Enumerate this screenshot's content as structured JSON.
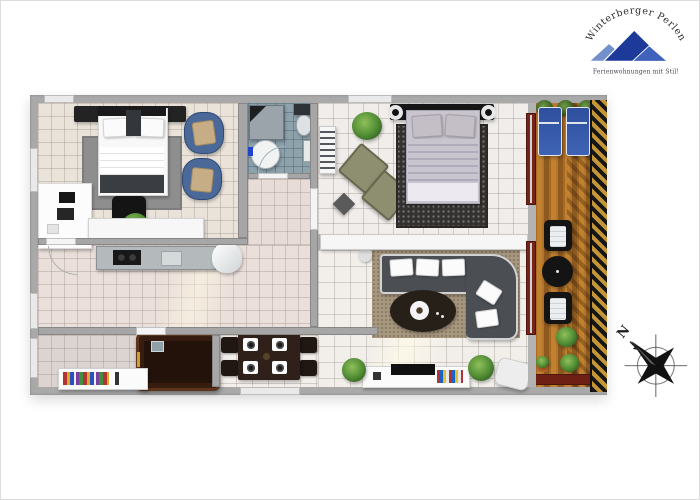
{
  "branding": {
    "title": "Winterberger Perlen",
    "tagline": "Ferienwohnungen mit Stil!"
  },
  "compass": {
    "label": "N"
  },
  "icons": {
    "logo_mountain_icon": "blue-mountain-peaks",
    "compass_rose_icon": "eight-point-star-compass"
  },
  "colors": {
    "wall_gray": "#a9a9a9",
    "bedroom_floor": "#eae3da",
    "bathroom_floor": "#8ea2ac",
    "kitchen_floor": "#eadfda",
    "living_floor": "#f2efeb",
    "sauna_room_floor": "#dcd4d0",
    "balcony_wood": "#c1812f",
    "railing_stripe_gold": "#c49638",
    "railing_stripe_black": "#161616",
    "sliding_door_red": "#76241a",
    "sofa_gray": "#4b4f54",
    "armchair_blue": "#4a6898",
    "sauna_brown": "#23120a",
    "logo_blue_dark": "#1d3a9a",
    "logo_blue_light": "#7390cc",
    "logo_text": "#2b2b2b",
    "tagline_text": "#44424e",
    "compass_black": "#111111"
  }
}
